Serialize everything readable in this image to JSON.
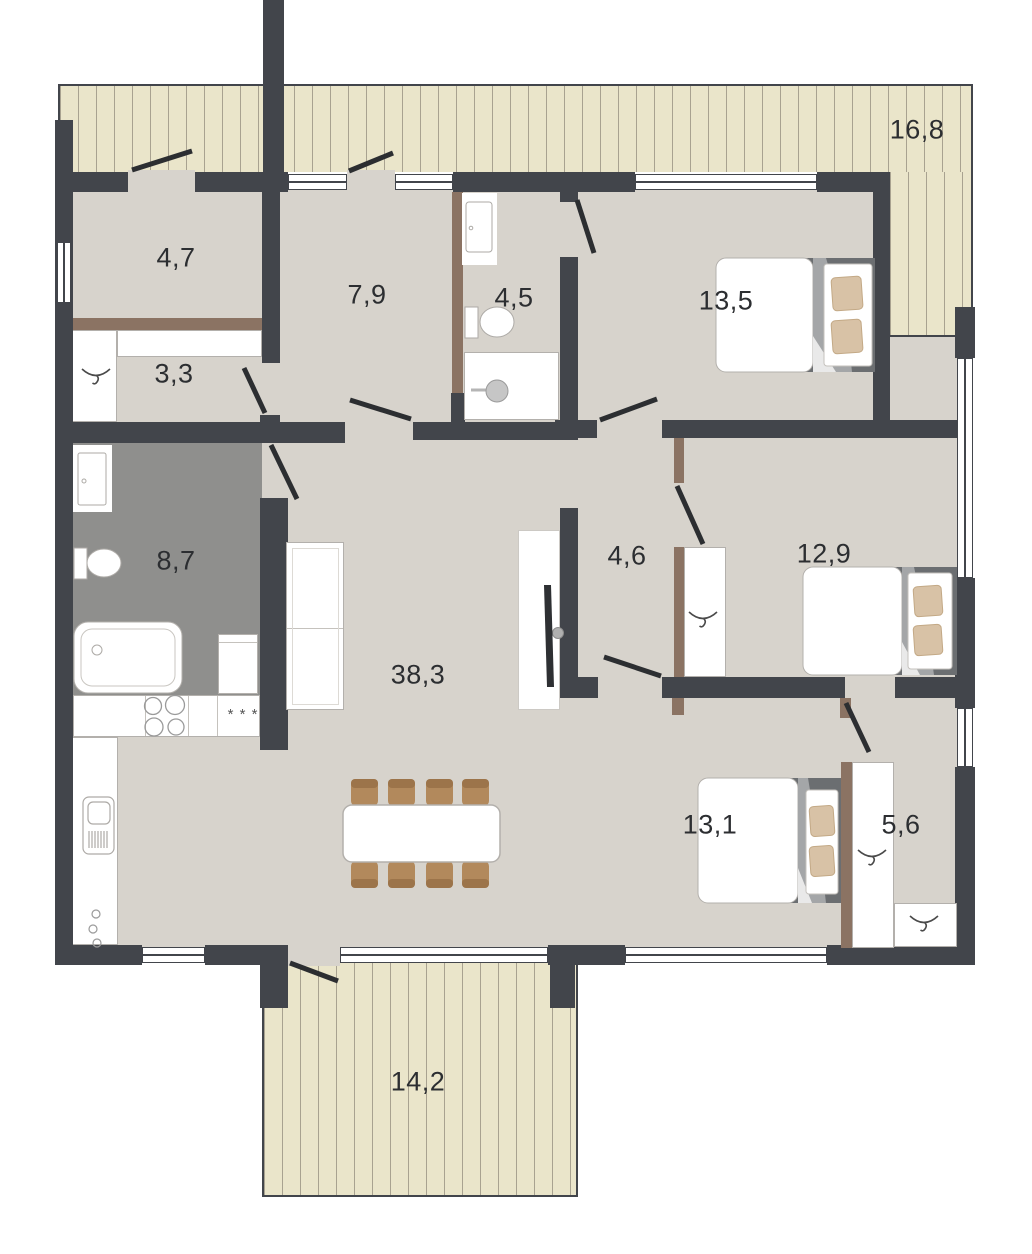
{
  "title": "Single-storey house floor plan",
  "rooms": {
    "terrace_top": {
      "name": "terrace",
      "area": "16,8"
    },
    "storage": {
      "name": "storage-room",
      "area": "4,7"
    },
    "hall": {
      "name": "hall",
      "area": "7,9"
    },
    "shower_room": {
      "name": "shower-room",
      "area": "4,5"
    },
    "bedroom1": {
      "name": "bedroom",
      "area": "13,5"
    },
    "entry": {
      "name": "entry",
      "area": "3,3"
    },
    "bathroom": {
      "name": "bathroom",
      "area": "8,7"
    },
    "living_kitchen": {
      "name": "living-kitchen",
      "area": "38,3"
    },
    "corridor": {
      "name": "corridor",
      "area": "4,6"
    },
    "bedroom2": {
      "name": "bedroom",
      "area": "12,9"
    },
    "bedroom3": {
      "name": "bedroom",
      "area": "13,1"
    },
    "wardrobe": {
      "name": "wardrobe",
      "area": "5,6"
    },
    "terrace_bottom": {
      "name": "terrace",
      "area": "14,2"
    }
  },
  "colors": {
    "wall": "#42454b",
    "floor": "#d7d3cc",
    "floor_wet_room": "#8f8f8d",
    "terrace_deck": "#eae5ca",
    "wood_partition": "#8b7363",
    "furniture_outline": "#b3b0ac",
    "pillow": "#d8c2a6",
    "chair": "#b2895c",
    "door_leaf": "#2c2e31"
  },
  "icons": {
    "hanger": "clothes-hanger-icon",
    "shower": "shower-head-icon",
    "stove": "four-burner-stove-icon",
    "dishwasher": "three-asterisks-icon"
  },
  "dishwasher_marks": "* * *"
}
